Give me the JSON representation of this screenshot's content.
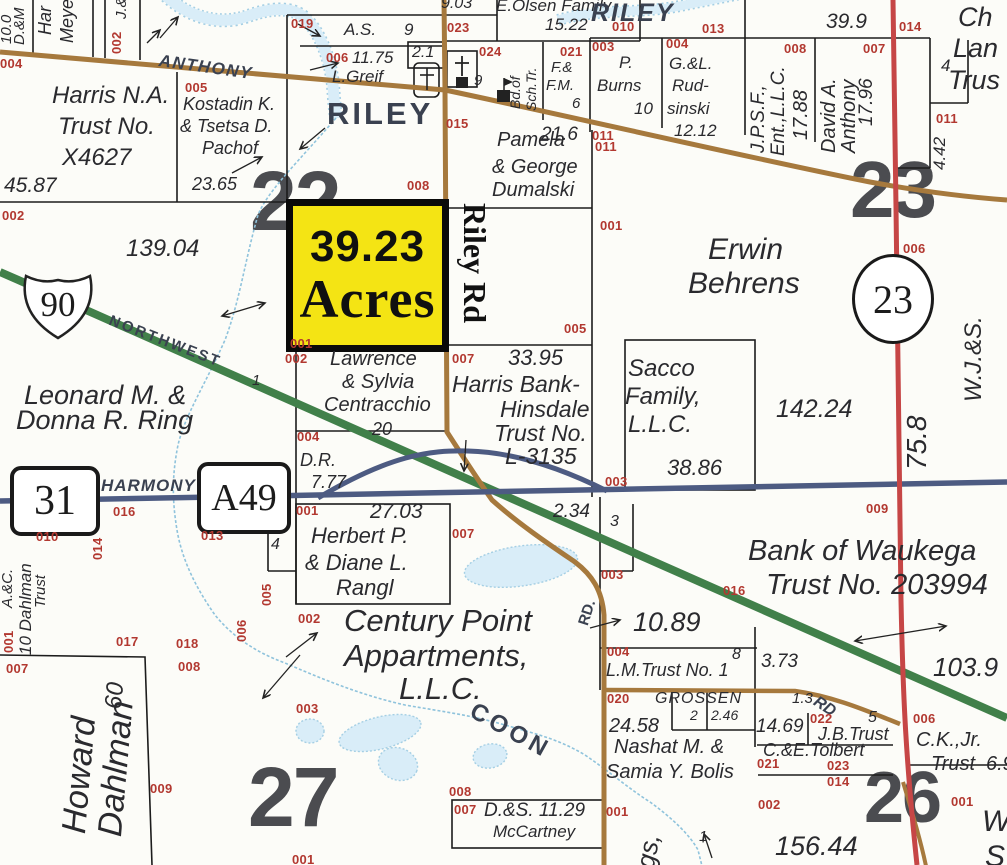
{
  "palette": {
    "road_brown": "#a6793d",
    "road_green": "#41804a",
    "road_red": "#c64646",
    "road_blue": "#4d5b82",
    "creek_fill": "#d9edf8",
    "creek_edge": "#a5cfe4",
    "parcel_line": "#1c1c1c",
    "highlight_yellow": "#f4e414",
    "pid_red": "#b23830",
    "label_dark": "#2a2a2e",
    "road_label": "#3a4150",
    "section_gray": "#4b4c50"
  },
  "highlight_parcel": {
    "acreage": "39.23",
    "unit": "Acres"
  },
  "shields": {
    "interstate": "90",
    "route_31": "31",
    "route_a49": "A49",
    "county_23": "23"
  },
  "labels": [
    {
      "t": "10.0",
      "x": 0,
      "y": 44,
      "r": -90,
      "fs": 15
    },
    {
      "t": "D.&M",
      "x": 13,
      "y": 45,
      "r": -90,
      "fs": 15
    },
    {
      "t": "Har",
      "x": 37,
      "y": 35,
      "r": -90,
      "fs": 18
    },
    {
      "t": "Meye",
      "x": 59,
      "y": 43,
      "r": -90,
      "fs": 18
    },
    {
      "t": "J.&",
      "x": 115,
      "y": 19,
      "r": -90,
      "fs": 15
    },
    {
      "t": "002",
      "x": 111,
      "y": 54,
      "r": -90,
      "c": "pid",
      "fs": 13
    },
    {
      "t": "004",
      "x": 0,
      "y": 58,
      "c": "pid",
      "fs": 13
    },
    {
      "t": "ANTHONY",
      "x": 160,
      "y": 53,
      "r": 8,
      "c": "rdi",
      "fs": 17,
      "ls": 1.5,
      "n": "road-label-anthony"
    },
    {
      "t": "Harris N.A.",
      "x": 52,
      "y": 85,
      "fs": 24
    },
    {
      "t": "Trust No.",
      "x": 58,
      "y": 116,
      "fs": 24
    },
    {
      "t": "X4627",
      "x": 62,
      "y": 147,
      "fs": 24
    },
    {
      "t": "45.87",
      "x": 4,
      "y": 176,
      "fs": 21
    },
    {
      "t": "005",
      "x": 185,
      "y": 82,
      "c": "pid",
      "fs": 13
    },
    {
      "t": "Kostadin K.",
      "x": 183,
      "y": 96,
      "fs": 18
    },
    {
      "t": "& Tsetsa D.",
      "x": 180,
      "y": 118,
      "fs": 18
    },
    {
      "t": "Pachof",
      "x": 202,
      "y": 140,
      "fs": 18
    },
    {
      "t": "23.65",
      "x": 192,
      "y": 176,
      "fs": 18
    },
    {
      "t": "019",
      "x": 291,
      "y": 18,
      "c": "pid",
      "fs": 13
    },
    {
      "t": "A.S.",
      "x": 344,
      "y": 22,
      "fs": 17
    },
    {
      "t": "9",
      "x": 404,
      "y": 22,
      "fs": 17
    },
    {
      "t": "9.03",
      "x": 441,
      "y": -4,
      "fs": 16
    },
    {
      "t": "E.Olsen Family",
      "x": 496,
      "y": -2,
      "fs": 17
    },
    {
      "t": "023",
      "x": 447,
      "y": 22,
      "c": "pid",
      "fs": 13
    },
    {
      "t": "15.22",
      "x": 545,
      "y": 17,
      "fs": 17
    },
    {
      "t": "010",
      "x": 612,
      "y": 21,
      "c": "pid",
      "fs": 13
    },
    {
      "t": "006",
      "x": 326,
      "y": 52,
      "c": "pid",
      "fs": 13
    },
    {
      "t": "11.75",
      "x": 352,
      "y": 50,
      "fs": 17
    },
    {
      "t": "L.Greif",
      "x": 332,
      "y": 69,
      "fs": 17
    },
    {
      "t": "2.1",
      "x": 412,
      "y": 45,
      "fs": 16
    },
    {
      "t": "024",
      "x": 479,
      "y": 46,
      "c": "pid",
      "fs": 13
    },
    {
      "t": "9",
      "x": 474,
      "y": 74,
      "fs": 15
    },
    {
      "t": "Bd.of",
      "x": 509,
      "y": 109,
      "r": -90,
      "fs": 14
    },
    {
      "t": "Sch.Tr.",
      "x": 525,
      "y": 111,
      "r": -90,
      "fs": 14
    },
    {
      "t": "021",
      "x": 560,
      "y": 46,
      "c": "pid",
      "fs": 13
    },
    {
      "t": "F.&",
      "x": 551,
      "y": 61,
      "fs": 15
    },
    {
      "t": "F.M.",
      "x": 546,
      "y": 79,
      "fs": 15
    },
    {
      "t": "6",
      "x": 572,
      "y": 97,
      "fs": 15
    },
    {
      "t": "RILEY",
      "x": 327,
      "y": 99,
      "c": "rd",
      "fs": 31,
      "ls": 3,
      "n": "road-label-riley"
    },
    {
      "t": "RILEY",
      "x": 591,
      "y": 2,
      "c": "rdi",
      "fs": 25,
      "ls": 2,
      "n": "road-label-riley-east"
    },
    {
      "t": "013",
      "x": 702,
      "y": 23,
      "c": "pid",
      "fs": 13
    },
    {
      "t": "39.9",
      "x": 826,
      "y": 12,
      "fs": 21
    },
    {
      "t": "014",
      "x": 899,
      "y": 21,
      "c": "pid",
      "fs": 13
    },
    {
      "t": "Ch",
      "x": 958,
      "y": 5,
      "fs": 27
    },
    {
      "t": "Lan",
      "x": 953,
      "y": 36,
      "fs": 27
    },
    {
      "t": "Trus",
      "x": 948,
      "y": 68,
      "fs": 27
    },
    {
      "t": "003",
      "x": 592,
      "y": 41,
      "c": "pid",
      "fs": 13
    },
    {
      "t": "P.",
      "x": 619,
      "y": 55,
      "fs": 17
    },
    {
      "t": "Burns",
      "x": 597,
      "y": 78,
      "fs": 17
    },
    {
      "t": "10",
      "x": 634,
      "y": 101,
      "fs": 17
    },
    {
      "t": "004",
      "x": 666,
      "y": 38,
      "c": "pid",
      "fs": 13
    },
    {
      "t": "G.&L.",
      "x": 669,
      "y": 56,
      "fs": 17
    },
    {
      "t": "Rud-",
      "x": 672,
      "y": 78,
      "fs": 17
    },
    {
      "t": "sinski",
      "x": 667,
      "y": 101,
      "fs": 17
    },
    {
      "t": "12.12",
      "x": 674,
      "y": 123,
      "fs": 17
    },
    {
      "t": "008",
      "x": 784,
      "y": 43,
      "c": "pid",
      "fs": 13
    },
    {
      "t": "J.P.S.F.,",
      "x": 750,
      "y": 153,
      "r": -90,
      "fs": 19
    },
    {
      "t": "Ent.,L.L.C.",
      "x": 770,
      "y": 156,
      "r": -90,
      "fs": 19
    },
    {
      "t": "17.88",
      "x": 792,
      "y": 140,
      "r": -90,
      "fs": 20
    },
    {
      "t": "007",
      "x": 863,
      "y": 43,
      "c": "pid",
      "fs": 13
    },
    {
      "t": "David A.",
      "x": 820,
      "y": 153,
      "r": -90,
      "fs": 20
    },
    {
      "t": "Anthony",
      "x": 840,
      "y": 153,
      "r": -90,
      "fs": 20
    },
    {
      "t": "17.96",
      "x": 858,
      "y": 126,
      "r": -90,
      "fs": 19
    },
    {
      "t": "4",
      "x": 941,
      "y": 58,
      "fs": 17
    },
    {
      "t": "011",
      "x": 936,
      "y": 113,
      "c": "pid",
      "fs": 13
    },
    {
      "t": "4.42",
      "x": 932,
      "y": 170,
      "r": -90,
      "fs": 17
    },
    {
      "t": "011",
      "x": 592,
      "y": 130,
      "c": "pid",
      "fs": 13
    },
    {
      "t": "002",
      "x": 2,
      "y": 210,
      "c": "pid",
      "fs": 13
    },
    {
      "t": "139.04",
      "x": 126,
      "y": 238,
      "fs": 24
    },
    {
      "t": "22",
      "x": 250,
      "y": 162,
      "c": "sec",
      "fs": 84,
      "u": 1,
      "n": "section-number-22"
    },
    {
      "t": "23",
      "x": 850,
      "y": 152,
      "c": "sec",
      "fs": 80,
      "u": 1,
      "n": "section-number-23"
    },
    {
      "t": "27",
      "x": 248,
      "y": 758,
      "c": "sec",
      "fs": 84,
      "u": 1,
      "n": "section-number-27"
    },
    {
      "t": "26",
      "x": 864,
      "y": 764,
      "c": "sec",
      "fs": 72,
      "u": 1,
      "n": "section-number-26"
    },
    {
      "t": "NORTHWEST",
      "x": 112,
      "y": 314,
      "r": 21,
      "c": "rd",
      "fs": 15,
      "ls": 2.5,
      "n": "road-label-northwest"
    },
    {
      "t": "Leonard M. &",
      "x": 24,
      "y": 383,
      "fs": 27
    },
    {
      "t": "Donna R. Ring",
      "x": 16,
      "y": 408,
      "fs": 27
    },
    {
      "t": "001",
      "x": 290,
      "y": 338,
      "c": "pid",
      "fs": 13
    },
    {
      "t": "002",
      "x": 285,
      "y": 353,
      "c": "pid",
      "fs": 13
    },
    {
      "t": "Lawrence",
      "x": 330,
      "y": 350,
      "fs": 20
    },
    {
      "t": "& Sylvia",
      "x": 342,
      "y": 373,
      "fs": 20
    },
    {
      "t": "Centracchio",
      "x": 324,
      "y": 396,
      "fs": 20
    },
    {
      "t": "20",
      "x": 372,
      "y": 421,
      "fs": 18
    },
    {
      "t": "Riley Rd",
      "x": 490,
      "y": 203,
      "r": 90,
      "c": "rr",
      "fs": 32,
      "n": "road-label-riley-rd"
    },
    {
      "t": "001",
      "x": 600,
      "y": 220,
      "c": "pid",
      "fs": 13
    },
    {
      "t": "Erwin",
      "x": 708,
      "y": 236,
      "fs": 30
    },
    {
      "t": "Behrens",
      "x": 688,
      "y": 270,
      "fs": 30
    },
    {
      "t": "006",
      "x": 903,
      "y": 243,
      "c": "pid",
      "fs": 13
    },
    {
      "t": "W.J.&S.",
      "x": 963,
      "y": 402,
      "r": -90,
      "fs": 24
    },
    {
      "t": "75.8",
      "x": 904,
      "y": 470,
      "r": -90,
      "fs": 28
    },
    {
      "t": "142.24",
      "x": 776,
      "y": 398,
      "fs": 25
    },
    {
      "t": "005",
      "x": 564,
      "y": 323,
      "c": "pid",
      "fs": 13
    },
    {
      "t": "007",
      "x": 452,
      "y": 353,
      "c": "pid",
      "fs": 13
    },
    {
      "t": "33.95",
      "x": 508,
      "y": 348,
      "fs": 22
    },
    {
      "t": "Harris Bank-",
      "x": 452,
      "y": 374,
      "fs": 23
    },
    {
      "t": "Hinsdale",
      "x": 500,
      "y": 399,
      "fs": 23
    },
    {
      "t": "Trust No.",
      "x": 494,
      "y": 423,
      "fs": 23
    },
    {
      "t": "L-3135",
      "x": 505,
      "y": 446,
      "fs": 23
    },
    {
      "t": "Sacco",
      "x": 628,
      "y": 358,
      "fs": 24
    },
    {
      "t": "Family,",
      "x": 625,
      "y": 386,
      "fs": 24
    },
    {
      "t": "L.L.C.",
      "x": 628,
      "y": 414,
      "fs": 24
    },
    {
      "t": "38.86",
      "x": 667,
      "y": 458,
      "fs": 22
    },
    {
      "t": "015",
      "x": 446,
      "y": 118,
      "c": "pid",
      "fs": 13
    },
    {
      "t": "Pamela",
      "x": 497,
      "y": 131,
      "fs": 20
    },
    {
      "t": "& George",
      "x": 492,
      "y": 158,
      "fs": 20
    },
    {
      "t": "Dumalski",
      "x": 492,
      "y": 181,
      "fs": 20
    },
    {
      "t": "21.6",
      "x": 541,
      "y": 126,
      "fs": 19
    },
    {
      "t": "011",
      "x": 595,
      "y": 141,
      "c": "pid",
      "fs": 13
    },
    {
      "t": "008",
      "x": 407,
      "y": 180,
      "c": "pid",
      "fs": 13
    },
    {
      "t": "HARMONY",
      "x": 101,
      "y": 478,
      "c": "rdi",
      "fs": 17,
      "ls": 1,
      "n": "road-label-harmony"
    },
    {
      "t": "016",
      "x": 113,
      "y": 506,
      "c": "pid",
      "fs": 13
    },
    {
      "t": "010",
      "x": 36,
      "y": 531,
      "c": "pid",
      "fs": 13
    },
    {
      "t": "014",
      "x": 92,
      "y": 560,
      "r": -90,
      "c": "pid",
      "fs": 13
    },
    {
      "t": "013",
      "x": 201,
      "y": 530,
      "c": "pid",
      "fs": 13
    },
    {
      "t": "A.&C.",
      "x": 1,
      "y": 608,
      "r": -90,
      "fs": 15
    },
    {
      "t": "10 Dahlman",
      "x": 18,
      "y": 655,
      "r": -90,
      "fs": 17
    },
    {
      "t": "Trust",
      "x": 34,
      "y": 608,
      "r": -90,
      "fs": 15
    },
    {
      "t": "001",
      "x": 3,
      "y": 653,
      "r": -90,
      "c": "pid",
      "fs": 13
    },
    {
      "t": "005",
      "x": 261,
      "y": 606,
      "r": -90,
      "c": "pid",
      "fs": 13
    },
    {
      "t": "006",
      "x": 236,
      "y": 642,
      "r": -90,
      "c": "pid",
      "fs": 13
    },
    {
      "t": "004",
      "x": 297,
      "y": 431,
      "c": "pid",
      "fs": 13
    },
    {
      "t": "D.R.",
      "x": 300,
      "y": 452,
      "fs": 18
    },
    {
      "t": "7.77",
      "x": 311,
      "y": 474,
      "fs": 18
    },
    {
      "t": "001",
      "x": 296,
      "y": 505,
      "c": "pid",
      "fs": 13
    },
    {
      "t": "27.03",
      "x": 370,
      "y": 502,
      "fs": 21
    },
    {
      "t": "4",
      "x": 271,
      "y": 537,
      "fs": 16
    },
    {
      "t": "Herbert P.",
      "x": 311,
      "y": 526,
      "fs": 22
    },
    {
      "t": "& Diane L.",
      "x": 305,
      "y": 553,
      "fs": 22
    },
    {
      "t": "Rangl",
      "x": 336,
      "y": 578,
      "fs": 22
    },
    {
      "t": "007",
      "x": 452,
      "y": 528,
      "c": "pid",
      "fs": 13
    },
    {
      "t": "2.34",
      "x": 553,
      "y": 503,
      "fs": 19
    },
    {
      "t": "3",
      "x": 610,
      "y": 514,
      "fs": 16
    },
    {
      "t": "003",
      "x": 605,
      "y": 476,
      "c": "pid",
      "fs": 13
    },
    {
      "t": "003",
      "x": 601,
      "y": 569,
      "c": "pid",
      "fs": 13
    },
    {
      "t": "009",
      "x": 866,
      "y": 503,
      "c": "pid",
      "fs": 13
    },
    {
      "t": "Bank of Waukega",
      "x": 748,
      "y": 538,
      "fs": 29
    },
    {
      "t": "Trust No. 203994",
      "x": 766,
      "y": 572,
      "fs": 29
    },
    {
      "t": "016",
      "x": 723,
      "y": 585,
      "c": "pid",
      "fs": 13
    },
    {
      "t": "10.89",
      "x": 633,
      "y": 610,
      "fs": 27
    },
    {
      "t": "103.9",
      "x": 933,
      "y": 655,
      "fs": 26
    },
    {
      "t": "RD.",
      "x": 577,
      "y": 623,
      "r": -72,
      "c": "rd",
      "fs": 15,
      "n": "road-label-rd"
    },
    {
      "t": "017",
      "x": 116,
      "y": 636,
      "c": "pid",
      "fs": 13
    },
    {
      "t": "018",
      "x": 176,
      "y": 638,
      "c": "pid",
      "fs": 13
    },
    {
      "t": "008",
      "x": 178,
      "y": 661,
      "c": "pid",
      "fs": 13
    },
    {
      "t": "007",
      "x": 6,
      "y": 663,
      "c": "pid",
      "fs": 13
    },
    {
      "t": "Howard",
      "x": 58,
      "y": 832,
      "r": -85,
      "fs": 34
    },
    {
      "t": "Dahlman",
      "x": 94,
      "y": 835,
      "r": -85,
      "fs": 34
    },
    {
      "t": "60",
      "x": 103,
      "y": 708,
      "r": -85,
      "fs": 24
    },
    {
      "t": "009",
      "x": 150,
      "y": 783,
      "c": "pid",
      "fs": 13
    },
    {
      "t": "002",
      "x": 298,
      "y": 613,
      "c": "pid",
      "fs": 13
    },
    {
      "t": "Century Point",
      "x": 344,
      "y": 606,
      "fs": 31
    },
    {
      "t": "Appartments,",
      "x": 344,
      "y": 641,
      "fs": 31
    },
    {
      "t": "L.L.C.",
      "x": 399,
      "y": 674,
      "fs": 31
    },
    {
      "t": "COON",
      "x": 477,
      "y": 700,
      "r": 29,
      "c": "rd",
      "fs": 24,
      "ls": 4,
      "n": "road-label-coon"
    },
    {
      "t": "003",
      "x": 296,
      "y": 703,
      "c": "pid",
      "fs": 13
    },
    {
      "t": "1",
      "x": 252,
      "y": 374,
      "fs": 15
    },
    {
      "t": "1",
      "x": 699,
      "y": 830,
      "fs": 15
    },
    {
      "t": "004",
      "x": 607,
      "y": 646,
      "c": "pid",
      "fs": 13
    },
    {
      "t": "8",
      "x": 732,
      "y": 647,
      "fs": 16
    },
    {
      "t": "L.M.Trust No. 1",
      "x": 606,
      "y": 662,
      "fs": 18
    },
    {
      "t": "3.73",
      "x": 761,
      "y": 653,
      "fs": 19
    },
    {
      "t": "020",
      "x": 607,
      "y": 693,
      "c": "pid",
      "fs": 13
    },
    {
      "t": "GROSSEN",
      "x": 655,
      "y": 691,
      "fs": 16,
      "ls": 1
    },
    {
      "t": "2",
      "x": 690,
      "y": 709,
      "fs": 14
    },
    {
      "t": "2.46",
      "x": 711,
      "y": 709,
      "fs": 14
    },
    {
      "t": "24.58",
      "x": 609,
      "y": 717,
      "fs": 20
    },
    {
      "t": "14.69",
      "x": 756,
      "y": 718,
      "fs": 19
    },
    {
      "t": "1.3",
      "x": 792,
      "y": 692,
      "fs": 15
    },
    {
      "t": "RD",
      "x": 819,
      "y": 694,
      "r": 33,
      "c": "rdi",
      "fs": 16,
      "n": "road-label-rd-grossen"
    },
    {
      "t": "022",
      "x": 810,
      "y": 713,
      "c": "pid",
      "fs": 13
    },
    {
      "t": "5",
      "x": 868,
      "y": 710,
      "fs": 16
    },
    {
      "t": "J.B.Trust",
      "x": 818,
      "y": 726,
      "fs": 18
    },
    {
      "t": "006",
      "x": 913,
      "y": 713,
      "c": "pid",
      "fs": 13
    },
    {
      "t": "C.K.,Jr.",
      "x": 916,
      "y": 731,
      "fs": 20
    },
    {
      "t": "Trust",
      "x": 931,
      "y": 755,
      "fs": 20
    },
    {
      "t": "6.9",
      "x": 986,
      "y": 755,
      "fs": 20
    },
    {
      "t": "C.&E.Tolbert",
      "x": 763,
      "y": 742,
      "fs": 18
    },
    {
      "t": "Nashat M. &",
      "x": 614,
      "y": 738,
      "fs": 20
    },
    {
      "t": "Samia Y. Bolis",
      "x": 606,
      "y": 763,
      "fs": 20
    },
    {
      "t": "021",
      "x": 757,
      "y": 758,
      "c": "pid",
      "fs": 13
    },
    {
      "t": "023",
      "x": 827,
      "y": 760,
      "c": "pid",
      "fs": 13
    },
    {
      "t": "014",
      "x": 827,
      "y": 776,
      "c": "pid",
      "fs": 13
    },
    {
      "t": "002",
      "x": 758,
      "y": 799,
      "c": "pid",
      "fs": 13
    },
    {
      "t": "001",
      "x": 951,
      "y": 796,
      "c": "pid",
      "fs": 13
    },
    {
      "t": "156.44",
      "x": 775,
      "y": 834,
      "fs": 27
    },
    {
      "t": "W",
      "x": 982,
      "y": 808,
      "fs": 30
    },
    {
      "t": "S",
      "x": 985,
      "y": 843,
      "fs": 30
    },
    {
      "t": "008",
      "x": 449,
      "y": 786,
      "c": "pid",
      "fs": 13
    },
    {
      "t": "007",
      "x": 454,
      "y": 804,
      "c": "pid",
      "fs": 13
    },
    {
      "t": "D.&S. 11.29",
      "x": 484,
      "y": 802,
      "fs": 19
    },
    {
      "t": "McCartney",
      "x": 493,
      "y": 824,
      "fs": 17
    },
    {
      "t": "001",
      "x": 606,
      "y": 806,
      "c": "pid",
      "fs": 13
    },
    {
      "t": "gs,",
      "x": 633,
      "y": 866,
      "r": -80,
      "fs": 26
    },
    {
      "t": "001",
      "x": 292,
      "y": 854,
      "c": "pid",
      "fs": 13
    }
  ]
}
